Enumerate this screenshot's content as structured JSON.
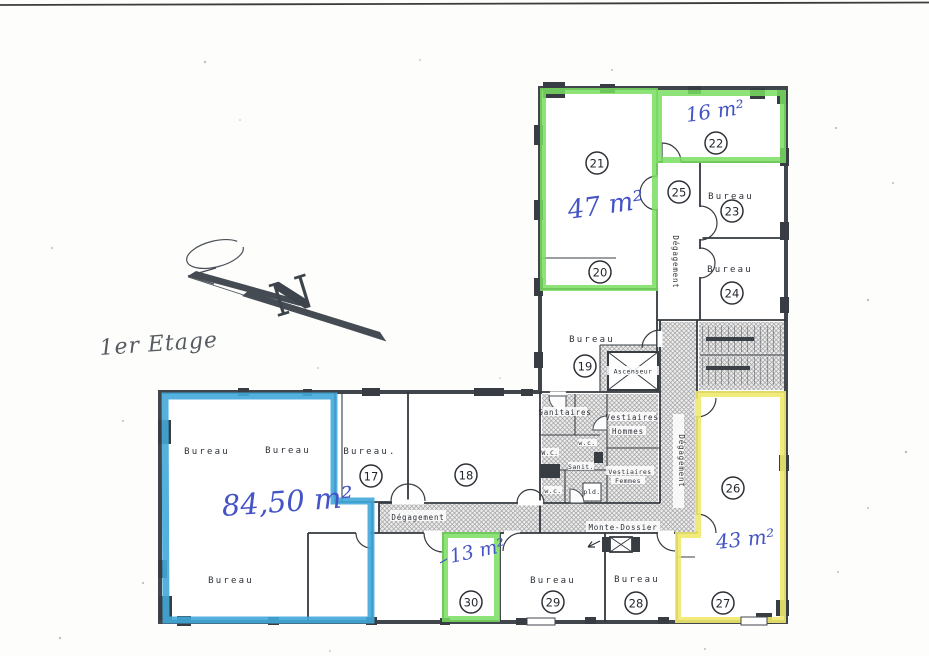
{
  "document": {
    "type_note": "scanned floor plan",
    "floor_label": "1er Etage",
    "north_letter": "N"
  },
  "areas": {
    "suite_21_20": "47 m²",
    "room_22": "16 m²",
    "suite_blue": "84,50 m²",
    "room_30": "13 m²",
    "suite_26_27": "43 m²"
  },
  "labels": {
    "bureau": "Bureau",
    "bureau_dot": "Bureau.",
    "degagement": "Dégagement",
    "ascenseur": "Ascenseur",
    "sanitaires": "Sanitaires",
    "vestiaires": "Vestiaires",
    "hommes": "Hommes",
    "femmes": "Femmes",
    "wc_upper": "W.C.",
    "wc_lower": "w.c.",
    "sanit": "Sanit.",
    "pld": "pld.",
    "monte_dossier": "Monte-Dossier"
  },
  "room_numbers": {
    "r17": "17",
    "r18": "18",
    "r19": "19",
    "r20": "20",
    "r21": "21",
    "r22": "22",
    "r23": "23",
    "r24": "24",
    "r25": "25",
    "r26": "26",
    "r27": "27",
    "r28": "28",
    "r29": "29",
    "r30": "30"
  },
  "highlights": {
    "green": {
      "color": "#79de60",
      "marks": [
        "suite 21+20 = 47 m²",
        "room 22 = 16 m²",
        "room 30 = 13 m²"
      ]
    },
    "blue": {
      "color": "#41a8da",
      "marks": [
        "office suite = 84,50 m²"
      ]
    },
    "yellow": {
      "color": "#efe96d",
      "marks": [
        "suite 26+27 = 43 m²"
      ]
    }
  },
  "colors": {
    "ink_blue": "#4453c5",
    "wall": "#41464d",
    "hatch_gray": "#a2a2a2",
    "paper": "#fdfdfc"
  }
}
